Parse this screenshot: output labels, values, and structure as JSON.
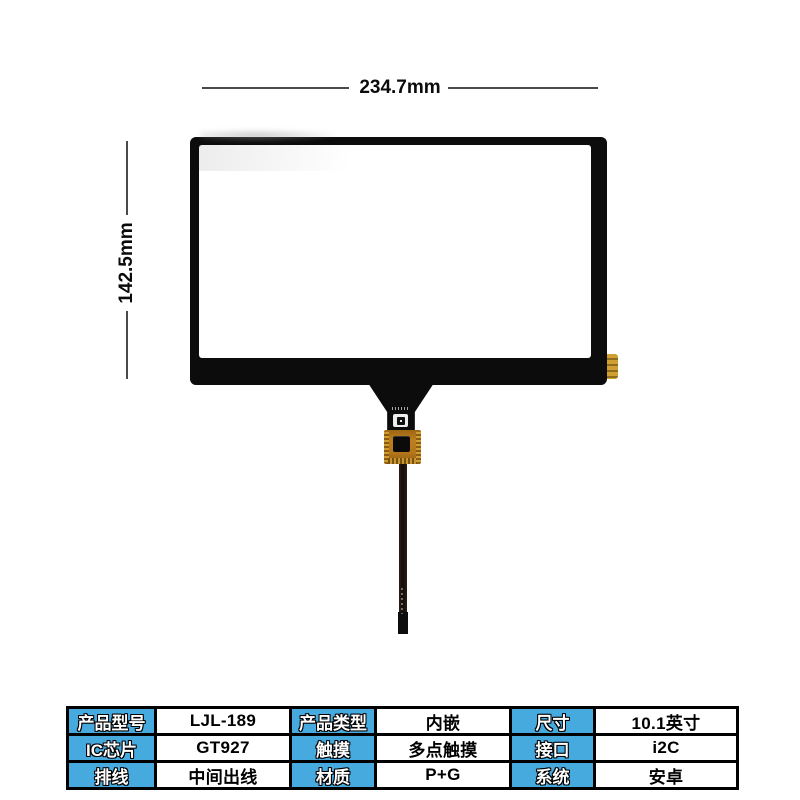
{
  "dimensions": {
    "width_label": "234.7mm",
    "height_label": "142.5mm"
  },
  "spec_table": {
    "rows": [
      {
        "cells": [
          {
            "kind": "header",
            "text": "产品型号"
          },
          {
            "kind": "value",
            "text": "LJL-189"
          },
          {
            "kind": "header",
            "text": "产品类型"
          },
          {
            "kind": "value",
            "text": "内嵌"
          },
          {
            "kind": "header",
            "text": "尺寸"
          },
          {
            "kind": "value",
            "text": "10.1英寸"
          }
        ]
      },
      {
        "cells": [
          {
            "kind": "header",
            "text": "IC芯片"
          },
          {
            "kind": "value",
            "text": "GT927"
          },
          {
            "kind": "header",
            "text": "触摸"
          },
          {
            "kind": "value",
            "text": "多点触摸"
          },
          {
            "kind": "header",
            "text": "接口"
          },
          {
            "kind": "value",
            "text": "i2C"
          }
        ]
      },
      {
        "cells": [
          {
            "kind": "header",
            "text": "排线"
          },
          {
            "kind": "value",
            "text": "中间出线"
          },
          {
            "kind": "header",
            "text": "材质"
          },
          {
            "kind": "value",
            "text": "P+G"
          },
          {
            "kind": "header",
            "text": "系统"
          },
          {
            "kind": "value",
            "text": "安卓"
          }
        ]
      }
    ]
  },
  "colors": {
    "table_header_blue": "#47aade",
    "table_border": "#000000",
    "dimension_line": "#4a4a4a",
    "panel_black": "#0c0c0c",
    "fpc_orange": "#b3761a",
    "gold_contact": "#cf9f31",
    "background": "#ffffff"
  }
}
